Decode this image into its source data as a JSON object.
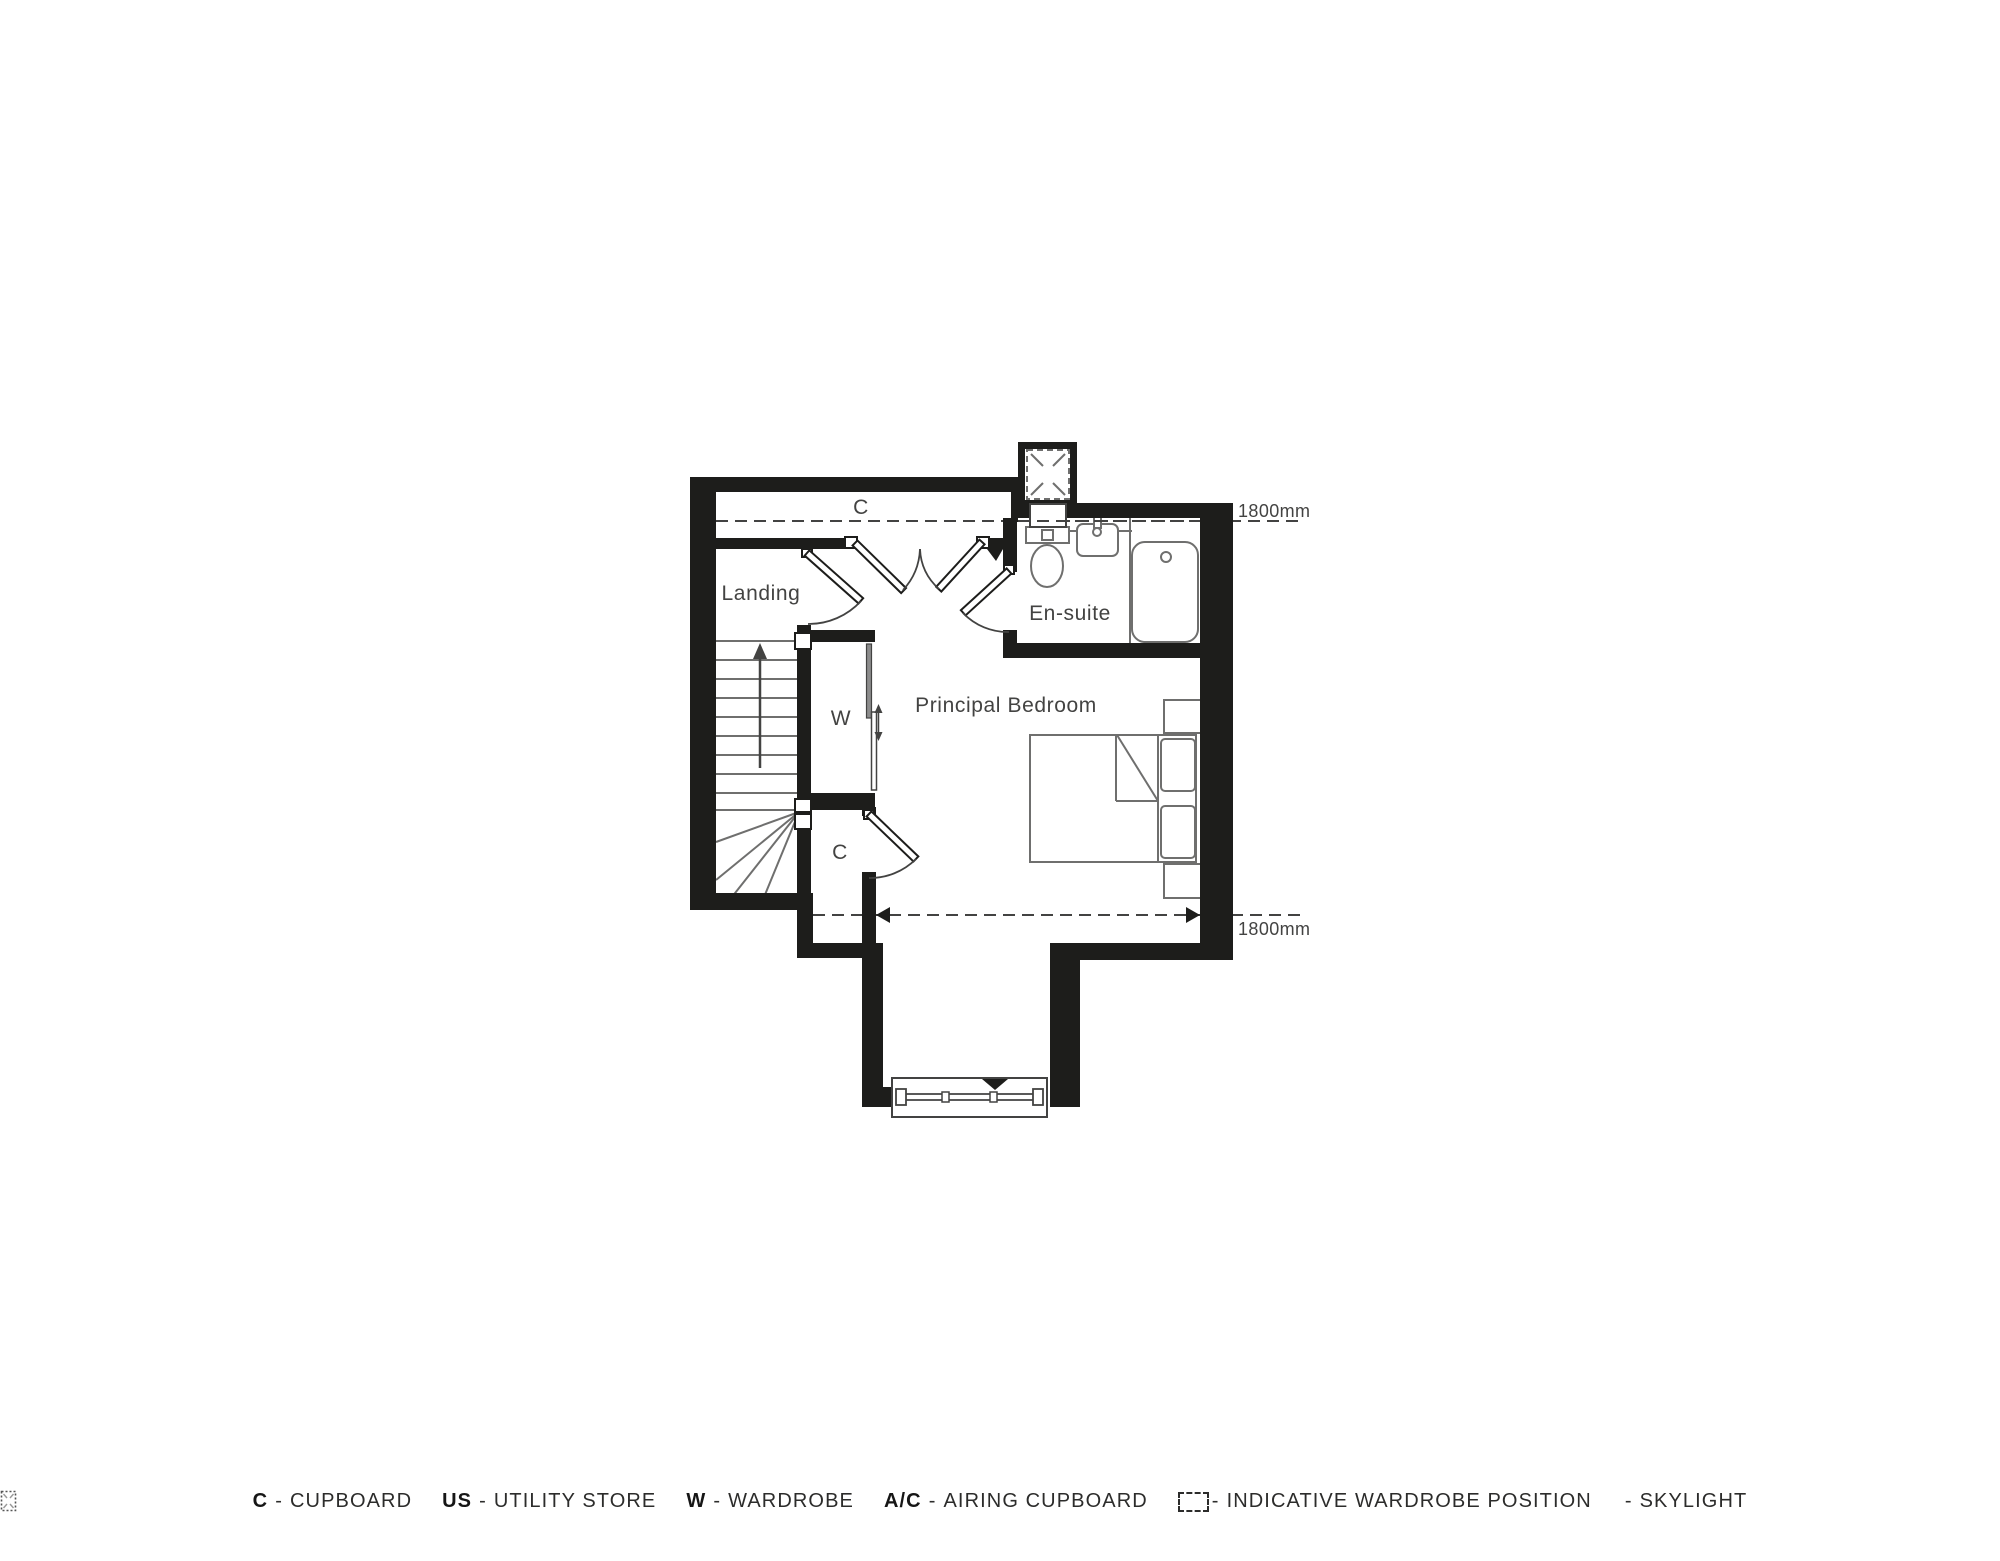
{
  "plan": {
    "rooms": {
      "landing": "Landing",
      "ensuite": "En-suite",
      "principal_bedroom": "Principal Bedroom",
      "wardrobe": "W",
      "cupboard_top": "C",
      "cupboard_lower": "C"
    },
    "dimensions": {
      "top_headroom": "1800mm",
      "bottom_headroom": "1800mm"
    }
  },
  "legend": {
    "items": [
      {
        "abbr": "C",
        "dash": "-",
        "label": "CUPBOARD"
      },
      {
        "abbr": "US",
        "dash": "-",
        "label": "UTILITY STORE"
      },
      {
        "abbr": "W",
        "dash": "-",
        "label": "WARDROBE"
      },
      {
        "abbr": "A/C",
        "dash": "-",
        "label": "AIRING CUPBOARD"
      },
      {
        "icon": "indicative-wardrobe-position-icon",
        "dash": "-",
        "label": "INDICATIVE WARDROBE POSITION"
      },
      {
        "icon": "skylight-icon",
        "dash": "-",
        "label": "SKYLIGHT"
      }
    ]
  },
  "colors": {
    "wall": "#1d1d1b",
    "line": "#434342",
    "fixture": "#6f6f6e",
    "text": "#434342"
  }
}
